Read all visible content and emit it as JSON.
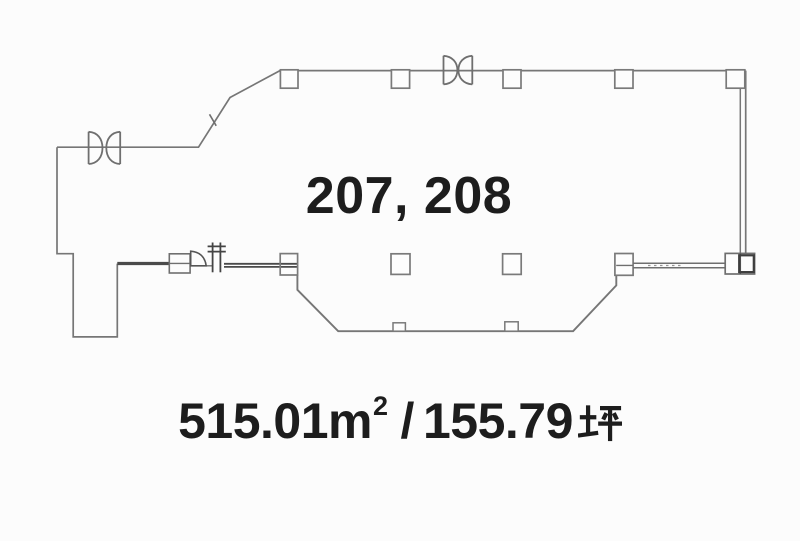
{
  "page": {
    "background": "#fcfcfc",
    "type_label": "floor-plan"
  },
  "plan": {
    "unit_numbers": "207, 208",
    "area": {
      "full_label": "515.01㎡ / 155.79坪",
      "sqm_value": "515.01",
      "sqm_unit_letter": "m",
      "sqm_unit_exponent": "2",
      "separator": "/",
      "tsubo_value": "155.79",
      "tsubo_unit": "坪"
    },
    "colors": {
      "outline_line": "#767676",
      "thick_wall": "#4a4a4a",
      "text": "#1d1d1d"
    },
    "icons": {
      "double_door": "bowtie-double-door-icon",
      "entrance_door": "swing-door-icon",
      "shaft": "shaft-hatch-icon"
    }
  }
}
